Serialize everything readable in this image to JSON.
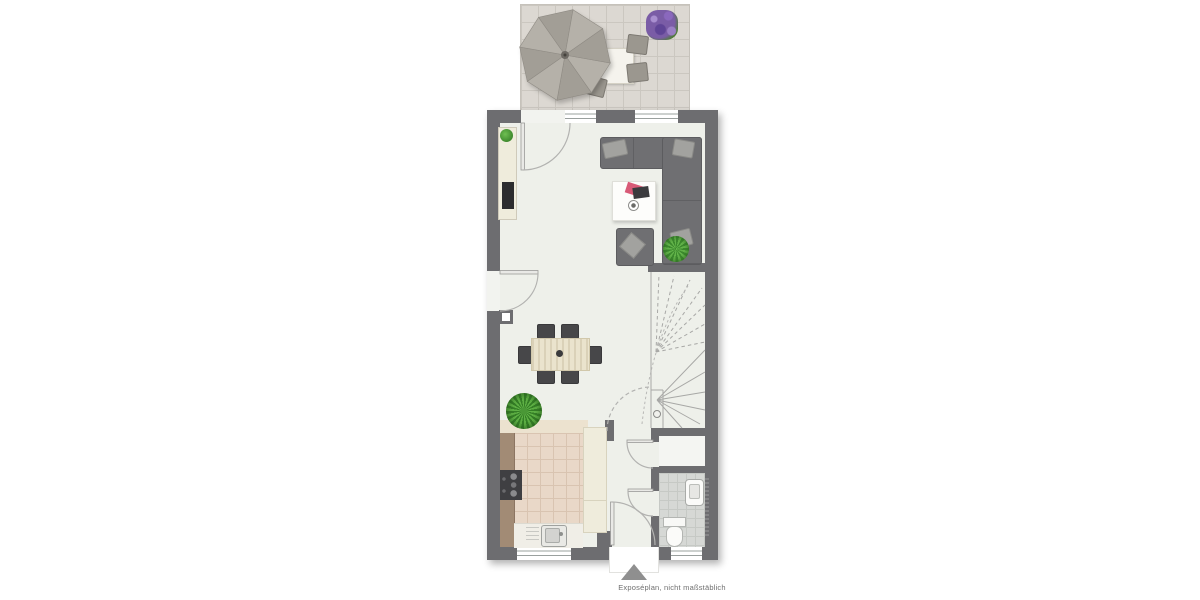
{
  "page": {
    "type": "floor-plan-expose",
    "background": "#ffffff"
  },
  "caption": {
    "text": "Exposéplan, nicht maßstäblich"
  },
  "entrance": {
    "marker": "arrow-up-triangle"
  },
  "palette": {
    "wall": "#6d6d70",
    "floor": "#eef0ea",
    "terrace_tile": "#dcd8d2",
    "kitchen_tile": "#e9d8c8",
    "bath_tile": "#d6d8d5",
    "sofa": "#6f6f72",
    "cushion": "#a2a29f",
    "dining_table_wood": "#eae3cd",
    "chair_dark": "#474749",
    "kitchen_counter_wood": "#a28b75",
    "cabinet_cream": "#efecdc",
    "plant_green": "#3f8a2e",
    "lavender_purple": "#7a5ca6",
    "entrance_arrow": "#8f8f8f",
    "door_arc_line": "#b2b2b0"
  },
  "areas": {
    "terrace": {
      "name": "terrace",
      "furniture": [
        "parasol",
        "patio-table",
        "patio-chairs",
        "lavender-planter"
      ]
    },
    "living_room": {
      "name": "living-room",
      "furniture": [
        "corner-sofa",
        "coffee-table",
        "armchair",
        "tv-sideboard",
        "potted-plant"
      ]
    },
    "dining_area": {
      "name": "dining-area",
      "furniture": [
        "dining-table",
        "six-chairs",
        "potted-plant"
      ]
    },
    "kitchen": {
      "name": "kitchen",
      "furniture": [
        "counter",
        "stove",
        "sink",
        "tall-cabinets"
      ]
    },
    "hallway": {
      "name": "hallway",
      "furniture": []
    },
    "bathroom": {
      "name": "bathroom",
      "furniture": [
        "washbasin",
        "toilet"
      ]
    },
    "staircase": {
      "name": "winder-staircase"
    },
    "storage_niche": {
      "name": "under-stair-niche"
    }
  }
}
